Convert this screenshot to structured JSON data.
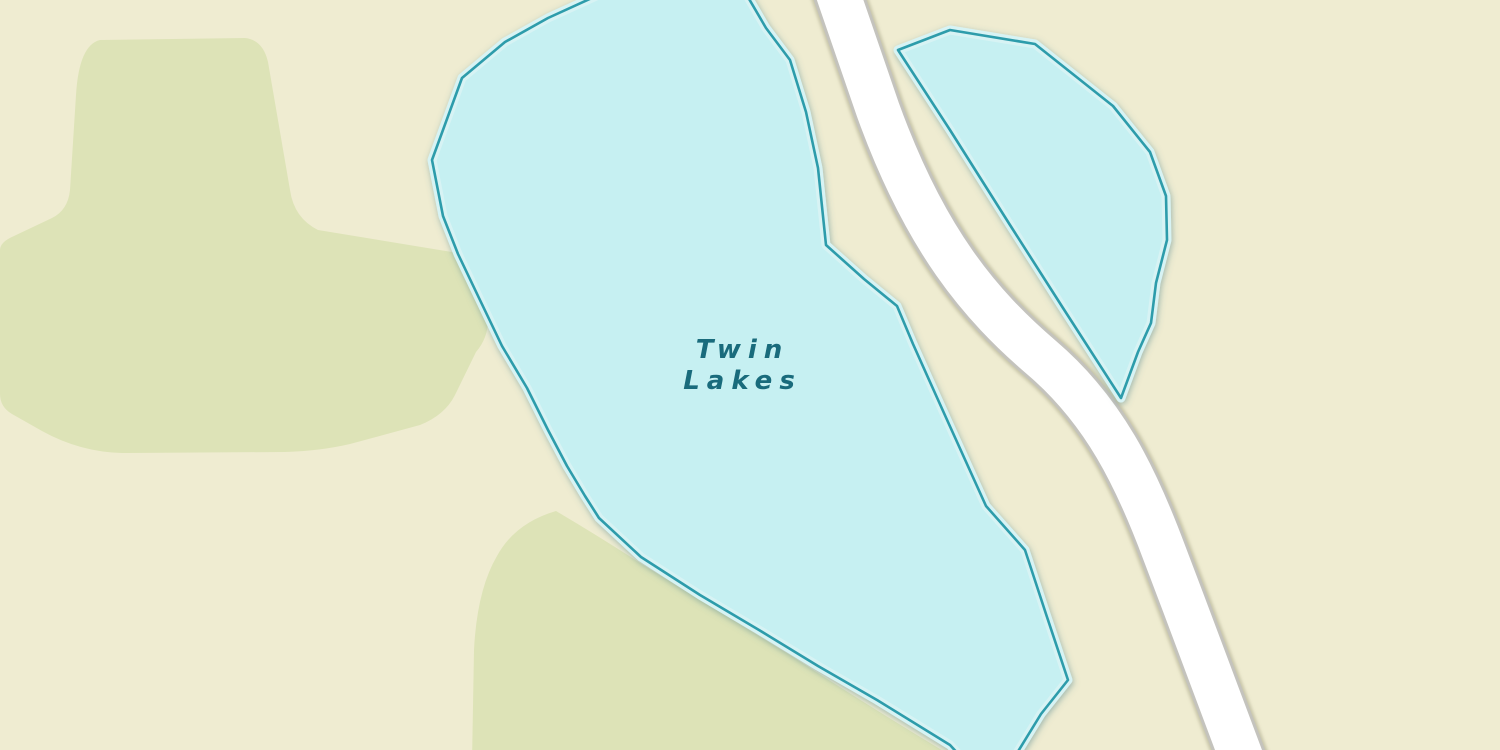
{
  "map": {
    "label": {
      "line1": "Twin",
      "line2": "Lakes"
    }
  },
  "features": {
    "water_bodies": [
      "main lake (south-west of road)",
      "small lake (north-east of road)"
    ],
    "road": "unnamed white road running diagonally from top to bottom-right",
    "vegetation_areas": [
      "large grass area top-left",
      "grass area bottom-center-left"
    ]
  },
  "colors": {
    "background": "#efecd1",
    "vegetation": "#dde3b7",
    "water_fill": "#c6f0f2",
    "water_outline": "#2d9cab",
    "water_halo": "#d7f3f4",
    "road_fill": "#ffffff",
    "road_casing": "#c4c3bd",
    "label_text": "#196b7c"
  }
}
